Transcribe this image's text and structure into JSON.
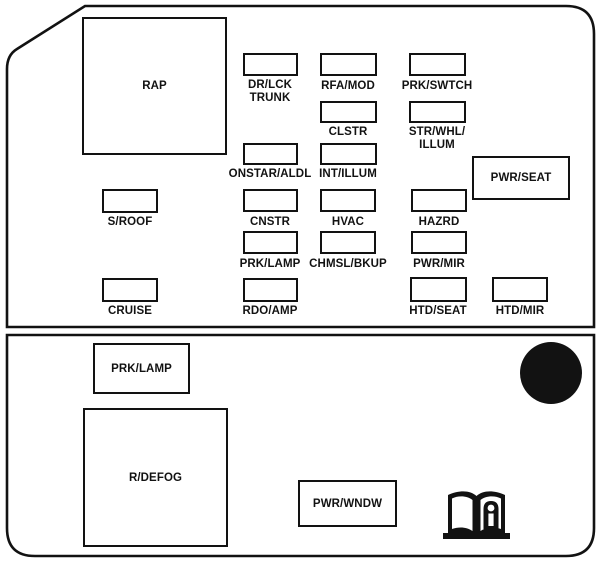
{
  "diagram_title": "Instrument panel fuse block diagram",
  "colors": {
    "ink": "#121212",
    "background": "#ffffff"
  },
  "top_section": {
    "rap": "RAP",
    "dr_lck_trunk": "DR/LCK\nTRUNK",
    "rfa_mod": "RFA/MOD",
    "prk_swtch": "PRK/SWTCH",
    "clstr": "CLSTR",
    "str_whl_illum": "STR/WHL/\nILLUM",
    "onstar_aldl": "ONSTAR/ALDL",
    "int_illum": "INT/ILLUM",
    "pwr_seat": "PWR/SEAT",
    "s_roof": "S/ROOF",
    "cnstr": "CNSTR",
    "hvac": "HVAC",
    "hazrd": "HAZRD",
    "prk_lamp": "PRK/LAMP",
    "chmsl_bkup": "CHMSL/BKUP",
    "pwr_mir": "PWR/MIR",
    "cruise": "CRUISE",
    "rdo_amp": "RDO/AMP",
    "htd_seat": "HTD/SEAT",
    "htd_mir": "HTD/MIR"
  },
  "bottom_section": {
    "prk_lamp": "PRK/LAMP",
    "r_defog": "R/DEFOG",
    "pwr_wndw": "PWR/WNDW"
  },
  "icons": {
    "black_circle": "round-black-marker",
    "owners_manual": "open-book-with-info-i"
  }
}
